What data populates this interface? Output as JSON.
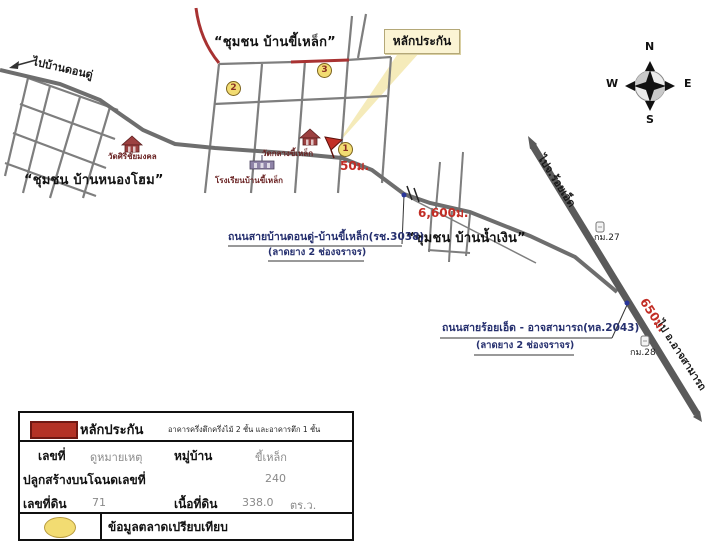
{
  "map": {
    "directions": {
      "to_ban_dondu": "ไปบ้านดอนดู่",
      "to_roiet": "ไปจ.ร้อยเอ็ด",
      "to_atsamat": "ไป อ.อาจสามารถ"
    },
    "communities": {
      "khilek": "“ชุมชน บ้านขี้เหล็ก”",
      "nonghom": "“ชุมชน บ้านหนองโฮม”",
      "namngoen": "“ชุมชน บ้านน้ำเงิน”"
    },
    "places": {
      "temple_sirichaimongkol": "วัดศิริชัยมงคล",
      "temple_klangkhilek": "วัดกลางขี้เหล็ก",
      "school_bankhilek": "โรงเรียนบ้านขี้เหล็ก"
    },
    "collateral_callout": "หลักประกัน",
    "distances": {
      "to_site": "50ม.",
      "along_road": "6,600ม.",
      "to_km28": "650ม."
    },
    "roads": {
      "road1_name": "ถนนสายบ้านดอนดู่-บ้านขี้เหล็ก(รช.3038)",
      "road1_lanes": "(ลาดยาง 2 ช่องจราจร)",
      "road2_name": "ถนนสายร้อยเอ็ด - อาจสามารถ(ทล.2043)",
      "road2_lanes": "(ลาดยาง 2 ช่องจราจร)"
    },
    "km_markers": {
      "km27": "กม.27",
      "km28": "กม.28"
    },
    "compass": {
      "n": "N",
      "s": "S",
      "e": "E",
      "w": "W"
    },
    "points": {
      "p1": "1",
      "p2": "2",
      "p3": "3"
    }
  },
  "legend": {
    "collateral_label": "หลักประกัน",
    "building_desc": "อาคารครึ่งตึกครึ่งไม้ 2 ชั้น และอาคารตึก 1 ชั้น",
    "house_no_label": "เลขที่",
    "house_no_value": "ดูหมายเหตุ",
    "village_label": "หมู่บ้าน",
    "village_value": "ขี้เหล็ก",
    "deed_label": "ปลูกสร้างบนโฉนดเลขที่",
    "deed_value": "240",
    "parcel_label": "เลขที่ดิน",
    "parcel_value": "71",
    "area_label": "เนื้อที่ดิน",
    "area_value": "338.0",
    "area_unit": "ตร.ว.",
    "market_label": "ข้อมูลตลาดเปรียบเทียบ"
  },
  "colors": {
    "red_road": "#a83232",
    "red_text": "#c22d25",
    "road_gray": "#6e6e6e",
    "highway_gray": "#5a5a5a",
    "label_navy": "#26306f",
    "legend_swatch": "#b33226",
    "point_circle": "#f2dc72",
    "callout_bg": "#fbf4d4"
  }
}
